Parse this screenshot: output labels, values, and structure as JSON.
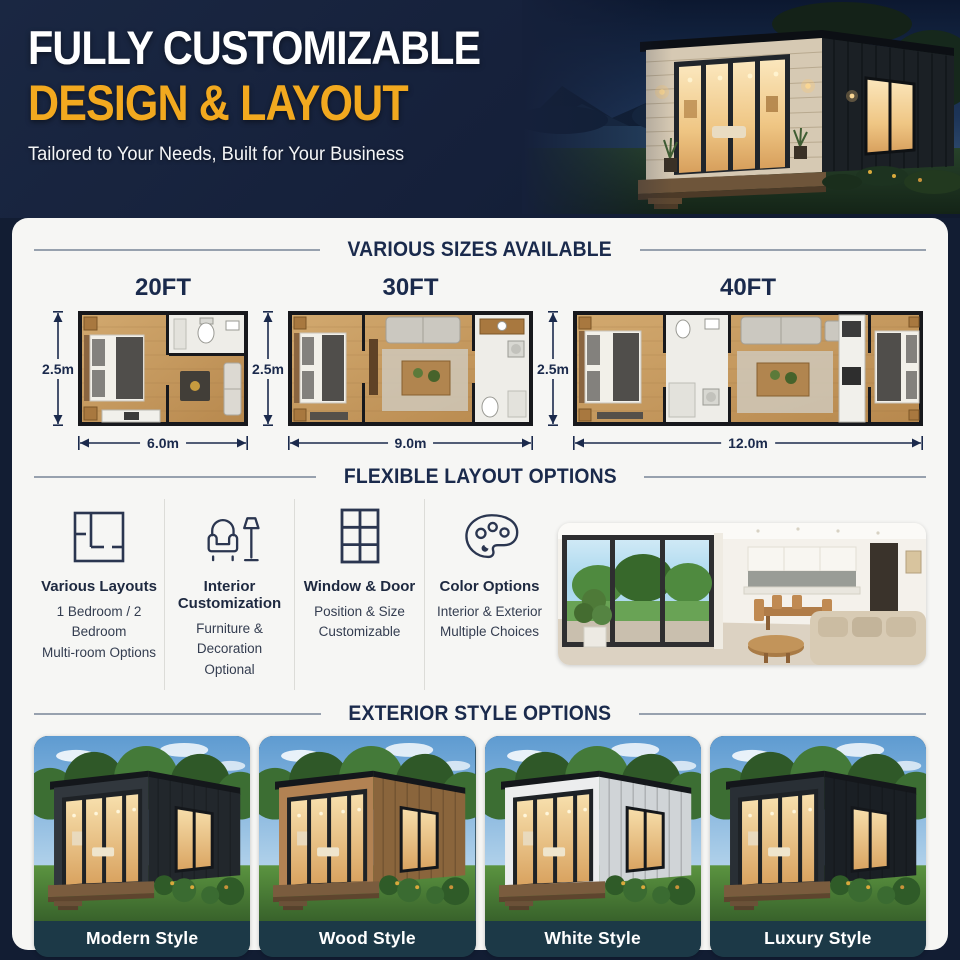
{
  "header": {
    "title_line1": "FULLY CUSTOMIZABLE",
    "title_line2": "DESIGN & LAYOUT",
    "subtitle": "Tailored to Your Needs, Built for Your Business"
  },
  "sections": {
    "sizes_title": "VARIOUS SIZES AVAILABLE",
    "layout_title": "FLEXIBLE LAYOUT OPTIONS",
    "exterior_title": "EXTERIOR STYLE OPTIONS"
  },
  "sizes": [
    {
      "name": "20FT",
      "height_label": "2.5m",
      "width_label": "6.0m"
    },
    {
      "name": "30FT",
      "height_label": "2.5m",
      "width_label": "9.0m"
    },
    {
      "name": "40FT",
      "height_label": "2.5m",
      "width_label": "12.0m"
    }
  ],
  "layout_options": [
    {
      "icon": "floorplan-icon",
      "title": "Various Layouts",
      "line1": "1 Bedroom / 2 Bedroom",
      "line2": "Multi-room Options"
    },
    {
      "icon": "armchair-lamp-icon",
      "title": "Interior Customization",
      "line1": "Furniture & Decoration",
      "line2": "Optional"
    },
    {
      "icon": "window-grid-icon",
      "title": "Window & Door",
      "line1": "Position & Size",
      "line2": "Customizable"
    },
    {
      "icon": "palette-icon",
      "title": "Color Options",
      "line1": "Interior & Exterior",
      "line2": "Multiple Choices"
    }
  ],
  "exterior_styles": [
    {
      "label": "Modern Style",
      "wall_front": "#31373D",
      "wall_side": "#22272C"
    },
    {
      "label": "Wood Style",
      "wall_front": "#B28253",
      "wall_side": "#8A653C"
    },
    {
      "label": "White Style",
      "wall_front": "#ECEDEE",
      "wall_side": "#D0D4D7"
    },
    {
      "label": "Luxury Style",
      "wall_front": "#292F35",
      "wall_side": "#1A1F24"
    }
  ],
  "colors": {
    "background_navy": "#15203A",
    "accent_yellow": "#F2A91F",
    "title_navy": "#1A2A4C",
    "card_background": "#F6F6F4",
    "style_label_bar": "#1C3947"
  }
}
